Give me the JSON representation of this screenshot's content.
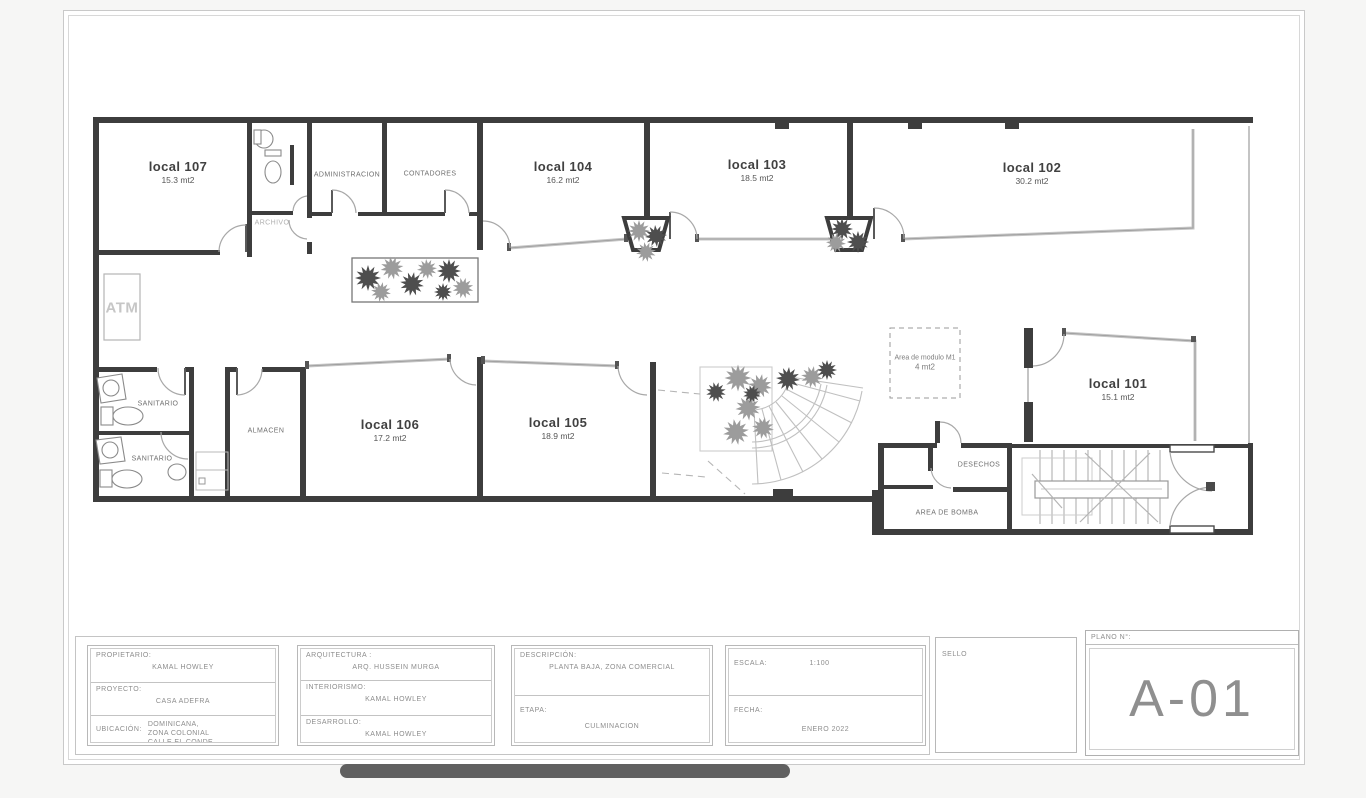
{
  "plan": {
    "rooms": [
      {
        "name": "local 107",
        "area": "15.3 mt2"
      },
      {
        "name": "local 104",
        "area": "16.2 mt2"
      },
      {
        "name": "local 103",
        "area": "18.5 mt2"
      },
      {
        "name": "local 102",
        "area": "30.2 mt2"
      },
      {
        "name": "local 106",
        "area": "17.2 mt2"
      },
      {
        "name": "local 105",
        "area": "18.9 mt2"
      },
      {
        "name": "local 101",
        "area": "15.1 mt2"
      }
    ],
    "small_rooms": [
      {
        "name": "ADMINISTRACION"
      },
      {
        "name": "CONTADORES"
      },
      {
        "name": "ARCHIVO"
      },
      {
        "name": "SANITARIO"
      },
      {
        "name": "SANITARIO"
      },
      {
        "name": "ALMACEN"
      },
      {
        "name": "DESECHOS"
      },
      {
        "name": "AREA DE BOMBA"
      },
      {
        "name": "ATM"
      }
    ],
    "module_note": {
      "line1": "Area de modulo M1",
      "line2": "4 mt2"
    }
  },
  "titleblock": {
    "propietario_label": "PROPIETARIO:",
    "propietario_value": "KAMAL HOWLEY",
    "proyecto_label": "PROYECTO:",
    "proyecto_value": "CASA ADEFRA",
    "ubicacion_label": "UBICACIÓN:",
    "ubicacion_value": "REPÚBLICA\nDOMINICANA,\nZONA COLONIAL\nCALLE EL CONDE",
    "arquitectura_label": "ARQUITECTURA :",
    "arquitectura_value": "ARQ. HUSSEIN MURGA",
    "interiorismo_label": "INTERIORISMO:",
    "interiorismo_value": "KAMAL HOWLEY",
    "desarrollo_label": "DESARROLLO:",
    "desarrollo_value": "KAMAL HOWLEY",
    "descripcion_label": "DESCRIPCIÓN:",
    "descripcion_value": "PLANTA BAJA, ZONA COMERCIAL",
    "etapa_label": "ETAPA:",
    "etapa_value": "CULMINACION",
    "escala_label": "ESCALA:",
    "escala_value": "1:100",
    "fecha_label": "FECHA:",
    "fecha_value": "ENERO 2022",
    "sello_label": "SELLO",
    "plano_label": "PLANO N°:",
    "plano_value": "A-01"
  }
}
